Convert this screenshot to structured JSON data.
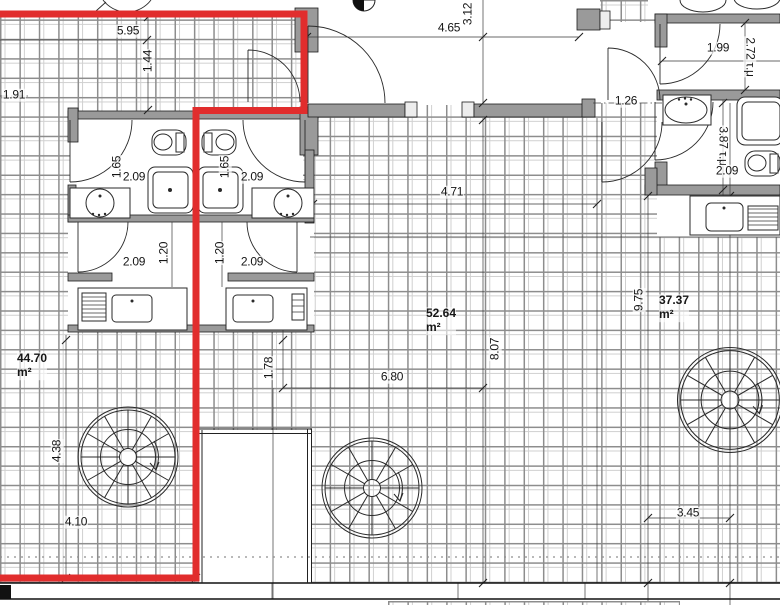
{
  "document": {
    "type": "architectural-floor-plan",
    "length_unit": "m",
    "area_unit": "m²",
    "area_unit_greek": "τ.μ"
  },
  "colors": {
    "boundary_red": "#e12d2d",
    "wall_gray": "#9a9a9a",
    "line_dark": "#2a2a2a",
    "tile_grid": "#8d8d8d"
  },
  "labels": [
    {
      "text": "5.95"
    },
    {
      "text": "1.44"
    },
    {
      "text": "1.91"
    },
    {
      "text": "4.65"
    },
    {
      "text": "3.12"
    },
    {
      "text": "1.26"
    },
    {
      "text": "1.99"
    },
    {
      "text": "2.72 τ.μ"
    },
    {
      "text": "3.87 τ.μ"
    },
    {
      "text": "2.09"
    },
    {
      "text": "1.65"
    },
    {
      "text": "2.09"
    },
    {
      "text": "1.65"
    },
    {
      "text": "2.09"
    },
    {
      "text": "2.09"
    },
    {
      "text": "1.20"
    },
    {
      "text": "1.20"
    },
    {
      "text": "2.09"
    },
    {
      "text": "4.71"
    },
    {
      "text": "8.07"
    },
    {
      "text": "6.80"
    },
    {
      "text": "1.78"
    },
    {
      "text": "4.38"
    },
    {
      "text": "4.10"
    },
    {
      "text": "9.75"
    },
    {
      "text": "3.45"
    }
  ],
  "areas": [
    {
      "value": "44.70",
      "unit": "m²"
    },
    {
      "value": "52.64",
      "unit": "m²"
    },
    {
      "value": "37.37",
      "unit": "m²"
    }
  ],
  "stairs": {
    "count": 3,
    "type": "spiral-staircase"
  },
  "fixtures_visible": [
    "toilet",
    "washbasin",
    "shower-tray",
    "kitchen-sink",
    "counter-with-drainboard"
  ]
}
